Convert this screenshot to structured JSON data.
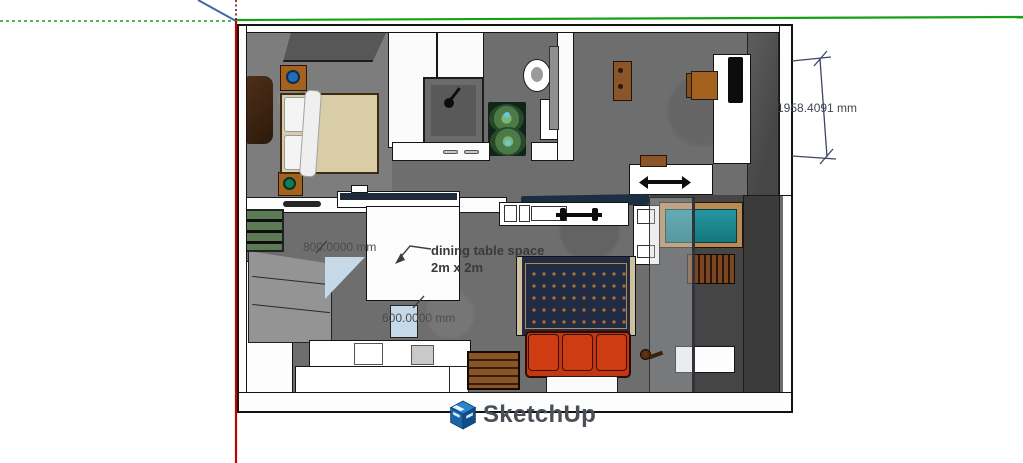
{
  "app": {
    "watermark": "SketchUp"
  },
  "viewport": {
    "annotations": {
      "dining_note": {
        "line1": "dining table space",
        "line2": "2m x 2m"
      },
      "dimensions": {
        "kitchen_width": "800.0000 mm",
        "counter_depth": "600.0000 mm",
        "right_wall_height": "1958.4091 mm"
      }
    },
    "axes": {
      "green": "#17a017",
      "red": "#c40000",
      "blue": "#3c68aa"
    },
    "colors": {
      "sofa": "#c23711",
      "rug": "#222b44",
      "daybed_cushion": "#1b8890",
      "floor_concrete": "#6e6e6e",
      "balcony_floor": "#454545",
      "bed_blanket": "#d8cda6",
      "wood_furniture": "#a5621f",
      "plant_green": "#5f9e5f",
      "highlight_face": "#c5d9e9",
      "logo_blue": "#1a66a8",
      "wordmark_gray": "#4a5056"
    }
  }
}
